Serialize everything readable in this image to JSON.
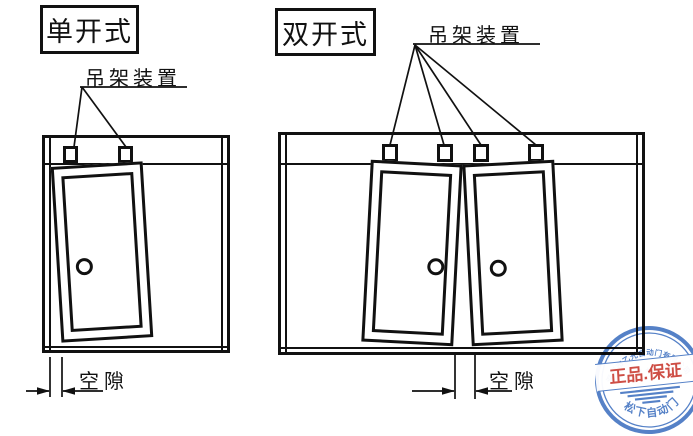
{
  "drawing": {
    "ink_color": "#111111",
    "panels": [
      {
        "id": "single-sliding",
        "title": "单开式",
        "hanger_label": "吊架装置",
        "gap_label": "空隙"
      },
      {
        "id": "double-sliding",
        "title": "双开式",
        "hanger_label": "吊架装置",
        "gap_label": "空隙"
      }
    ]
  },
  "stamp": {
    "company_arc_text": "深圳市乙光自动门有限公司",
    "stars": "★ ★ ★",
    "band_text": "正品.保证",
    "bottom_arc_text": "松下自动门",
    "ring_color": "#3d6fbf",
    "band_text_color": "#c8352b"
  }
}
